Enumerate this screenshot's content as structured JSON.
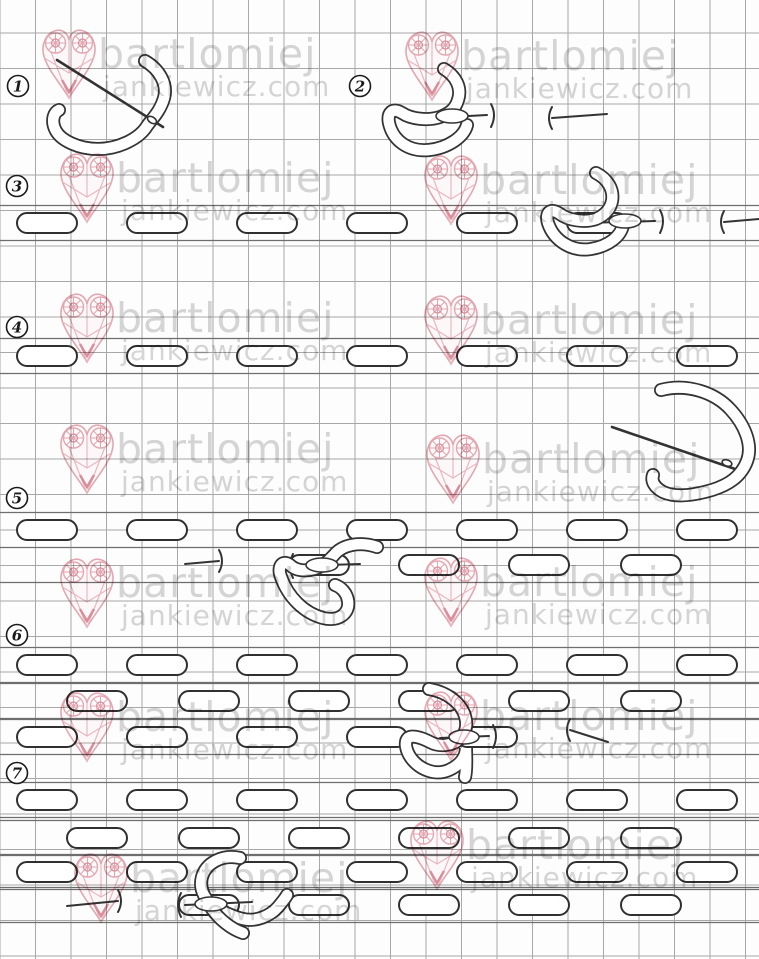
{
  "watermark": {
    "line1": "bartlomiej",
    "line2": "jankiewicz.com",
    "heart_color": "#e09aa6",
    "heart_accent_color": "#d4798a",
    "text_color": "#cfcfcf",
    "tiles": [
      {
        "x": 40,
        "y": 26
      },
      {
        "x": 403,
        "y": 28
      },
      {
        "x": 58,
        "y": 150
      },
      {
        "x": 422,
        "y": 152
      },
      {
        "x": 58,
        "y": 290
      },
      {
        "x": 422,
        "y": 292
      },
      {
        "x": 58,
        "y": 421
      },
      {
        "x": 424,
        "y": 431
      },
      {
        "x": 58,
        "y": 555
      },
      {
        "x": 422,
        "y": 554
      },
      {
        "x": 58,
        "y": 689
      },
      {
        "x": 422,
        "y": 688
      },
      {
        "x": 72,
        "y": 850
      },
      {
        "x": 408,
        "y": 817
      }
    ]
  },
  "grid": {
    "pitch": 35.5,
    "h_offset": 33,
    "line_color": "#a8a8a8",
    "row_line_color": "#6e6e6e",
    "background": "#fdfdfd"
  },
  "steps": [
    {
      "n": "1",
      "x": 18,
      "y": 86
    },
    {
      "n": "2",
      "x": 360,
      "y": 86
    },
    {
      "n": "3",
      "x": 17,
      "y": 186
    },
    {
      "n": "4",
      "x": 17,
      "y": 327
    },
    {
      "n": "5",
      "x": 17,
      "y": 498
    },
    {
      "n": "6",
      "x": 17,
      "y": 635
    },
    {
      "n": "7",
      "x": 17,
      "y": 773
    }
  ],
  "stitch": {
    "w": 60,
    "h": 20,
    "rx": 10,
    "outline": "#303030"
  },
  "stitch_rows": [
    {
      "y": 223,
      "xs": [
        17,
        127,
        237,
        347,
        457,
        567
      ]
    },
    {
      "y": 356,
      "xs": [
        17,
        127,
        237,
        347,
        457,
        567,
        677
      ]
    },
    {
      "y": 530,
      "xs": [
        17,
        127,
        237,
        347,
        457,
        567,
        677
      ]
    },
    {
      "y": 565,
      "xs": [
        289,
        399,
        509,
        621
      ]
    },
    {
      "y": 665,
      "xs": [
        17,
        127,
        237,
        347,
        457,
        567,
        677
      ]
    },
    {
      "y": 701,
      "xs": [
        67,
        179,
        289,
        399,
        509,
        621
      ]
    },
    {
      "y": 737,
      "xs": [
        17,
        127,
        237,
        347,
        457
      ]
    },
    {
      "y": 800,
      "xs": [
        17,
        127,
        237,
        347,
        457,
        567,
        677
      ]
    },
    {
      "y": 838,
      "xs": [
        67,
        179,
        289,
        399,
        509,
        621
      ]
    },
    {
      "y": 872,
      "xs": [
        17,
        127,
        237,
        347,
        457,
        567,
        677
      ]
    },
    {
      "y": 905,
      "xs": [
        179,
        289,
        399,
        509,
        621
      ]
    }
  ],
  "tack_needles": [
    {
      "x1": 552,
      "y1": 118,
      "x2": 607,
      "y2": 114,
      "bar": "left"
    },
    {
      "x1": 724,
      "y1": 222,
      "x2": 759,
      "y2": 219,
      "bar": "left"
    },
    {
      "x1": 185,
      "y1": 564,
      "x2": 219,
      "y2": 561,
      "bar": "right"
    },
    {
      "x1": 570,
      "y1": 730,
      "x2": 608,
      "y2": 742,
      "bar": "left"
    },
    {
      "x1": 67,
      "y1": 906,
      "x2": 118,
      "y2": 901,
      "bar": "right"
    }
  ]
}
